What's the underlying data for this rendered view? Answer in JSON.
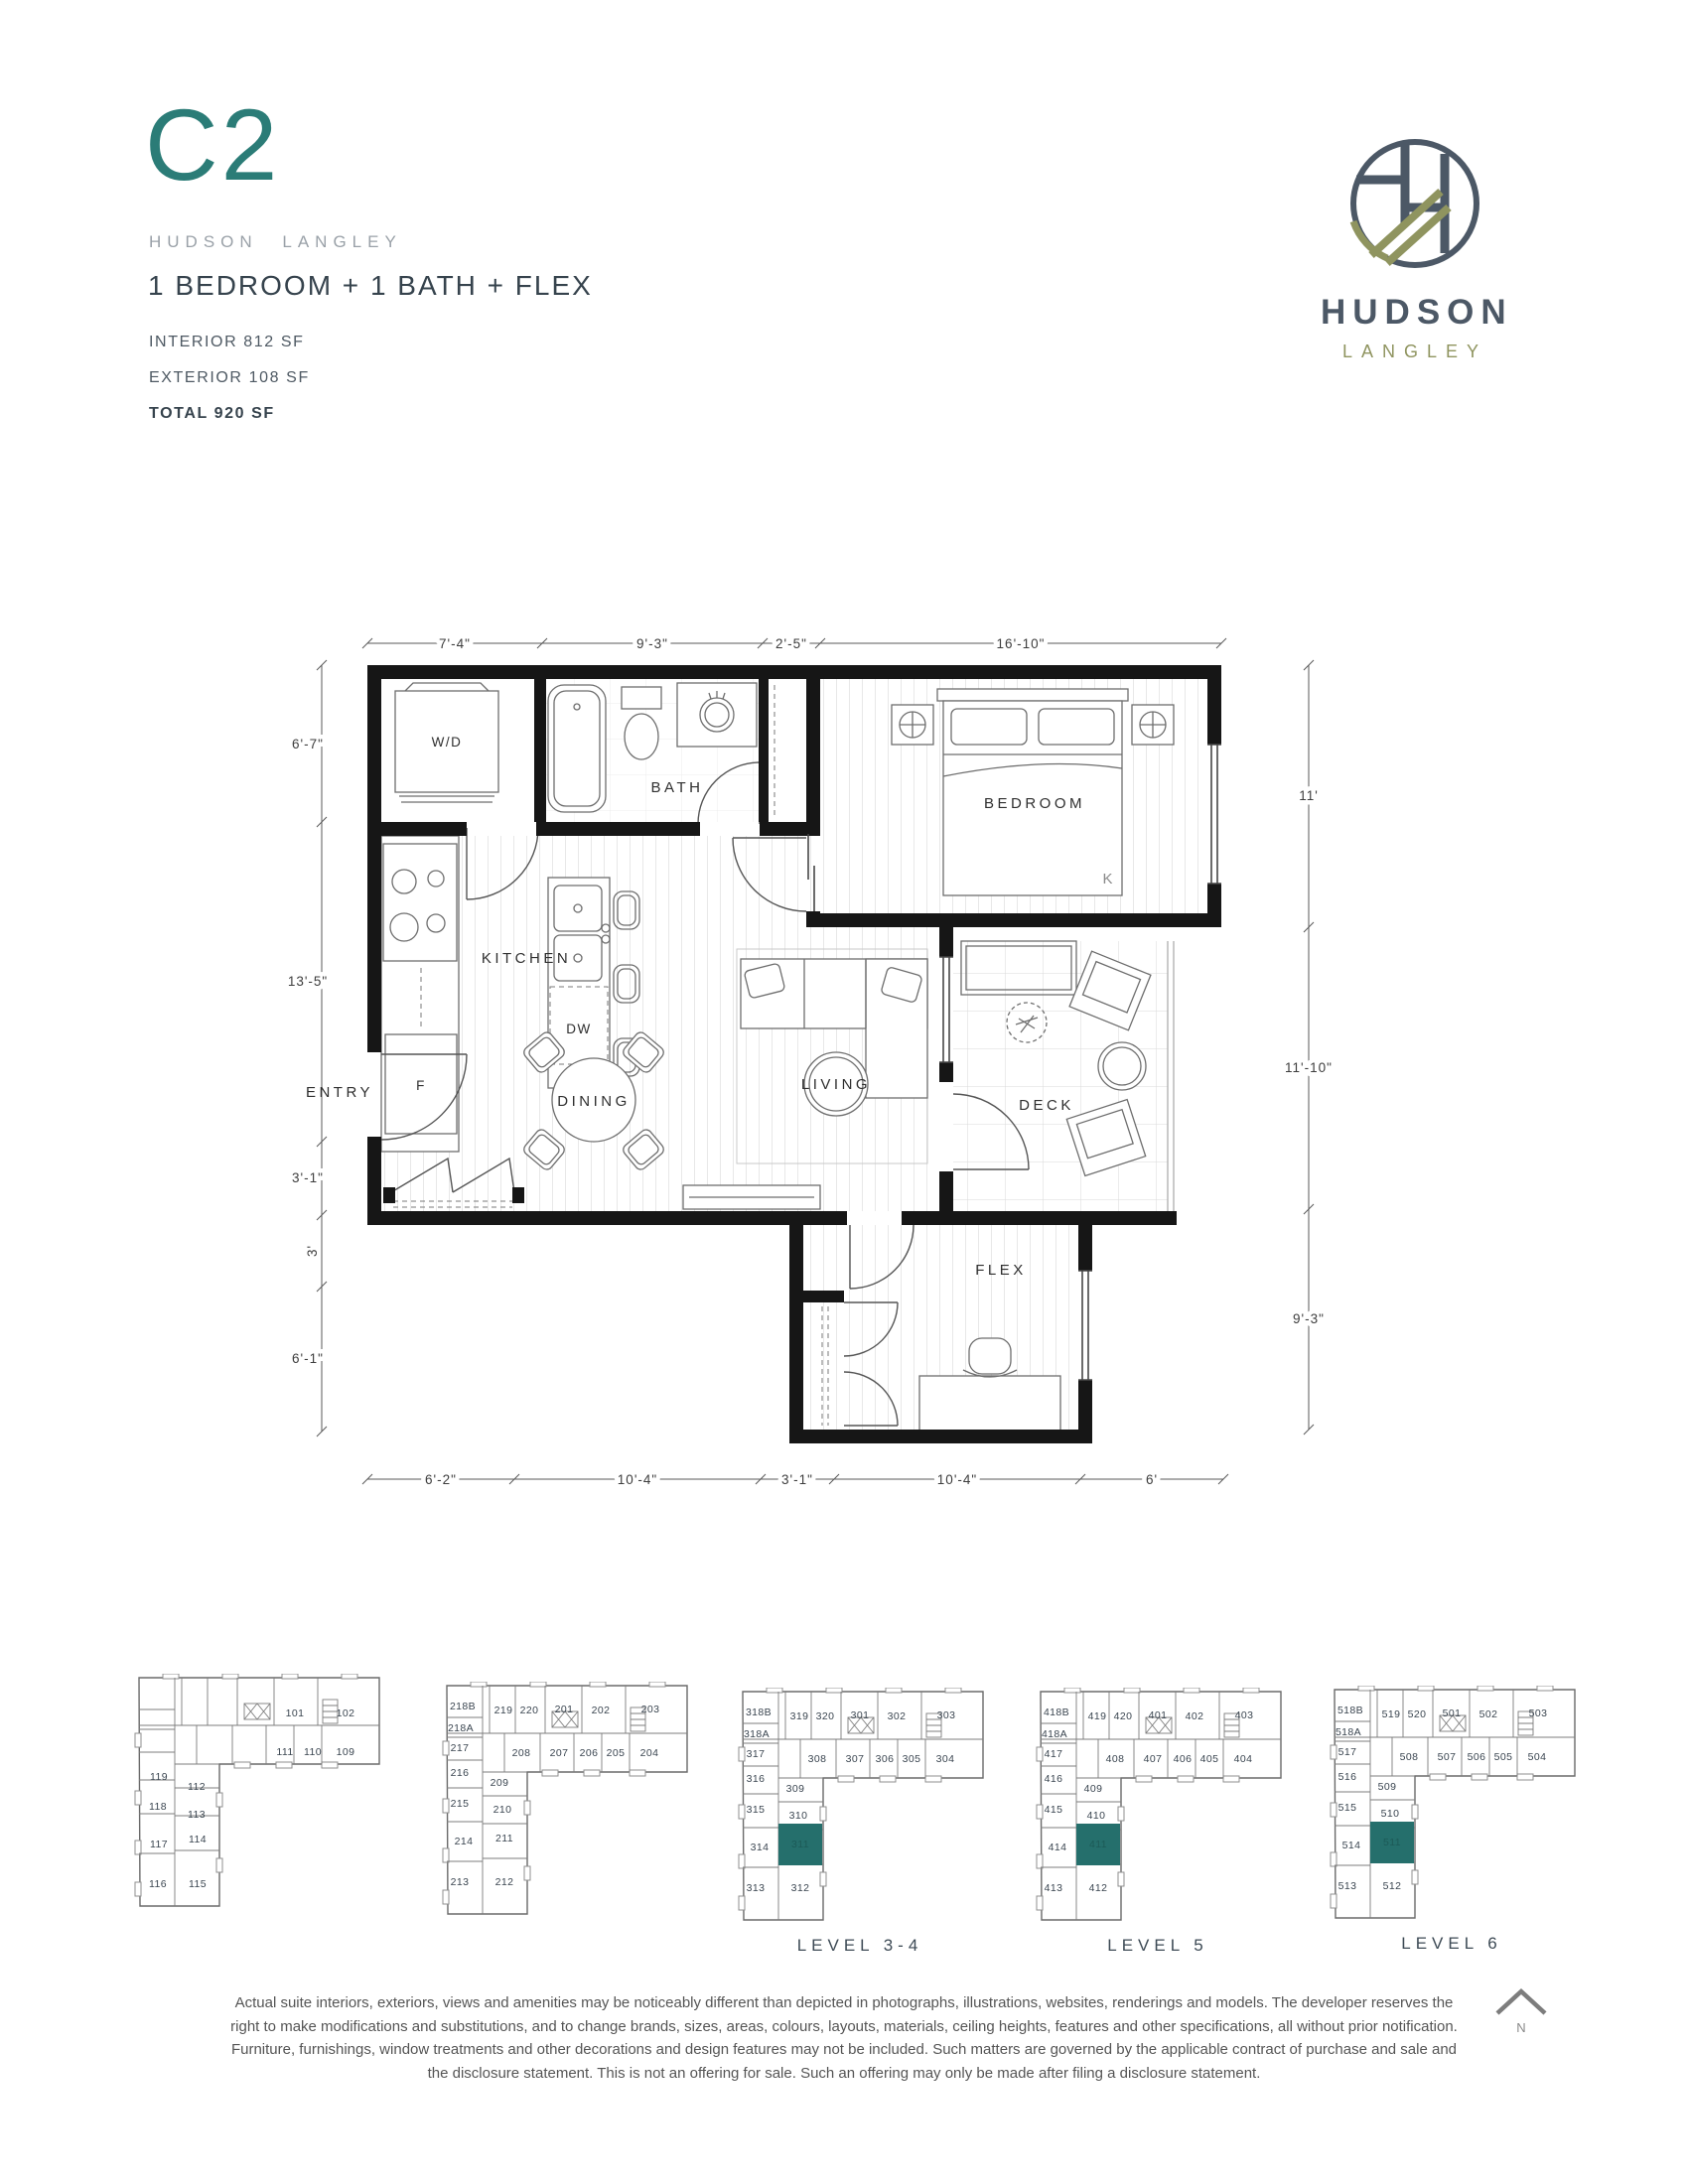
{
  "header": {
    "plan_code": "C2",
    "project_name": "HUDSON LANGLEY",
    "suite_type": "1 BEDROOM + 1 BATH + FLEX",
    "interior_label": "INTERIOR 812 SF",
    "exterior_label": "EXTERIOR 108 SF",
    "total_label": "TOTAL 920 SF"
  },
  "logo": {
    "wordmark": "HUDSON",
    "wordmark_sub": "LANGLEY"
  },
  "colors": {
    "accent_teal": "#2b7c77",
    "unit_highlight": "#256f6c",
    "slate": "#4c5866",
    "olive": "#8f945f"
  },
  "floor_plan": {
    "room_labels": {
      "wd": "W/D",
      "bath": "BATH",
      "bedroom": "BEDROOM",
      "bed_king": "K",
      "kitchen": "KITCHEN",
      "dishwasher": "DW",
      "fridge": "F",
      "entry": "ENTRY",
      "dining": "DINING",
      "living": "LIVING",
      "deck": "DECK",
      "flex": "FLEX"
    },
    "dimensions": {
      "top": [
        "7'-4\"",
        "9'-3\"",
        "2'-5\"",
        "16'-10\""
      ],
      "left": [
        "6'-7\"",
        "13'-5\"",
        "3'-1\"",
        "3'",
        "6'-1\""
      ],
      "right": [
        "11'",
        "11'-10\"",
        "9'-3\""
      ],
      "bottom": [
        "6'-2\"",
        "10'-4\"",
        "3'-1\"",
        "10'-4\"",
        "6'"
      ]
    }
  },
  "key_plans": [
    {
      "level_label": "",
      "units": [
        {
          "no": "101",
          "cls": "unit",
          "pos": "left:169px;top:40px"
        },
        {
          "no": "102",
          "cls": "unit",
          "pos": "left:220px;top:40px"
        },
        {
          "no": "111",
          "cls": "unit",
          "pos": "left:159px;top:79px"
        },
        {
          "no": "110",
          "cls": "unit",
          "pos": "left:187px;top:79px"
        },
        {
          "no": "109",
          "cls": "unit",
          "pos": "left:220px;top:79px"
        },
        {
          "no": "119",
          "cls": "unit",
          "pos": "left:32px;top:104px"
        },
        {
          "no": "112",
          "cls": "unit",
          "pos": "left:70px;top:114px"
        },
        {
          "no": "118",
          "cls": "unit",
          "pos": "left:31px;top:134px"
        },
        {
          "no": "113",
          "cls": "unit",
          "pos": "left:70px;top:142px"
        },
        {
          "no": "117",
          "cls": "unit",
          "pos": "left:32px;top:172px"
        },
        {
          "no": "114",
          "cls": "unit",
          "pos": "left:71px;top:167px"
        },
        {
          "no": "116",
          "cls": "unit",
          "pos": "left:31px;top:212px"
        },
        {
          "no": "115",
          "cls": "unit",
          "pos": "left:71px;top:212px"
        }
      ]
    },
    {
      "level_label": "",
      "units": [
        {
          "no": "218B",
          "cls": "unit",
          "pos": "left:28px;top:25px"
        },
        {
          "no": "219",
          "cls": "unit",
          "pos": "left:69px;top:29px"
        },
        {
          "no": "220",
          "cls": "unit",
          "pos": "left:95px;top:29px"
        },
        {
          "no": "201",
          "cls": "unit",
          "pos": "left:130px;top:28px"
        },
        {
          "no": "202",
          "cls": "unit",
          "pos": "left:167px;top:29px"
        },
        {
          "no": "203",
          "cls": "unit",
          "pos": "left:217px;top:28px"
        },
        {
          "no": "218A",
          "cls": "unit",
          "pos": "left:26px;top:47px"
        },
        {
          "no": "217",
          "cls": "unit",
          "pos": "left:25px;top:67px"
        },
        {
          "no": "208",
          "cls": "unit",
          "pos": "left:87px;top:72px"
        },
        {
          "no": "207",
          "cls": "unit",
          "pos": "left:125px;top:72px"
        },
        {
          "no": "206",
          "cls": "unit",
          "pos": "left:155px;top:72px"
        },
        {
          "no": "205",
          "cls": "unit",
          "pos": "left:182px;top:72px"
        },
        {
          "no": "204",
          "cls": "unit",
          "pos": "left:216px;top:72px"
        },
        {
          "no": "216",
          "cls": "unit",
          "pos": "left:25px;top:92px"
        },
        {
          "no": "209",
          "cls": "unit",
          "pos": "left:65px;top:102px"
        },
        {
          "no": "215",
          "cls": "unit",
          "pos": "left:25px;top:123px"
        },
        {
          "no": "210",
          "cls": "unit",
          "pos": "left:68px;top:129px"
        },
        {
          "no": "214",
          "cls": "unit",
          "pos": "left:29px;top:161px"
        },
        {
          "no": "211",
          "cls": "unit",
          "pos": "left:70px;top:158px"
        },
        {
          "no": "213",
          "cls": "unit",
          "pos": "left:25px;top:202px"
        },
        {
          "no": "212",
          "cls": "unit",
          "pos": "left:70px;top:202px"
        }
      ]
    },
    {
      "level_label": "LEVEL 3-4",
      "units": [
        {
          "no": "318B",
          "cls": "unit",
          "pos": "left:28px;top:25px"
        },
        {
          "no": "319",
          "cls": "unit",
          "pos": "left:69px;top:29px"
        },
        {
          "no": "320",
          "cls": "unit",
          "pos": "left:95px;top:29px"
        },
        {
          "no": "301",
          "cls": "unit",
          "pos": "left:130px;top:28px"
        },
        {
          "no": "302",
          "cls": "unit",
          "pos": "left:167px;top:29px"
        },
        {
          "no": "303",
          "cls": "unit",
          "pos": "left:217px;top:28px"
        },
        {
          "no": "318A",
          "cls": "unit",
          "pos": "left:26px;top:47px"
        },
        {
          "no": "317",
          "cls": "unit",
          "pos": "left:25px;top:67px"
        },
        {
          "no": "308",
          "cls": "unit",
          "pos": "left:87px;top:72px"
        },
        {
          "no": "307",
          "cls": "unit",
          "pos": "left:125px;top:72px"
        },
        {
          "no": "306",
          "cls": "unit",
          "pos": "left:155px;top:72px"
        },
        {
          "no": "305",
          "cls": "unit",
          "pos": "left:182px;top:72px"
        },
        {
          "no": "304",
          "cls": "unit",
          "pos": "left:216px;top:72px"
        },
        {
          "no": "316",
          "cls": "unit",
          "pos": "left:25px;top:92px"
        },
        {
          "no": "309",
          "cls": "unit",
          "pos": "left:65px;top:102px"
        },
        {
          "no": "315",
          "cls": "unit",
          "pos": "left:25px;top:123px"
        },
        {
          "no": "310",
          "cls": "unit",
          "pos": "left:68px;top:129px"
        },
        {
          "no": "314",
          "cls": "unit",
          "pos": "left:29px;top:161px"
        },
        {
          "no": "311",
          "cls": "unit hl",
          "pos": "left:70px;top:158px"
        },
        {
          "no": "313",
          "cls": "unit",
          "pos": "left:25px;top:202px"
        },
        {
          "no": "312",
          "cls": "unit",
          "pos": "left:70px;top:202px"
        }
      ]
    },
    {
      "level_label": "LEVEL 5",
      "units": [
        {
          "no": "418B",
          "cls": "unit",
          "pos": "left:28px;top:25px"
        },
        {
          "no": "419",
          "cls": "unit",
          "pos": "left:69px;top:29px"
        },
        {
          "no": "420",
          "cls": "unit",
          "pos": "left:95px;top:29px"
        },
        {
          "no": "401",
          "cls": "unit",
          "pos": "left:130px;top:28px"
        },
        {
          "no": "402",
          "cls": "unit",
          "pos": "left:167px;top:29px"
        },
        {
          "no": "403",
          "cls": "unit",
          "pos": "left:217px;top:28px"
        },
        {
          "no": "418A",
          "cls": "unit",
          "pos": "left:26px;top:47px"
        },
        {
          "no": "417",
          "cls": "unit",
          "pos": "left:25px;top:67px"
        },
        {
          "no": "408",
          "cls": "unit",
          "pos": "left:87px;top:72px"
        },
        {
          "no": "407",
          "cls": "unit",
          "pos": "left:125px;top:72px"
        },
        {
          "no": "406",
          "cls": "unit",
          "pos": "left:155px;top:72px"
        },
        {
          "no": "405",
          "cls": "unit",
          "pos": "left:182px;top:72px"
        },
        {
          "no": "404",
          "cls": "unit",
          "pos": "left:216px;top:72px"
        },
        {
          "no": "416",
          "cls": "unit",
          "pos": "left:25px;top:92px"
        },
        {
          "no": "409",
          "cls": "unit",
          "pos": "left:65px;top:102px"
        },
        {
          "no": "415",
          "cls": "unit",
          "pos": "left:25px;top:123px"
        },
        {
          "no": "410",
          "cls": "unit",
          "pos": "left:68px;top:129px"
        },
        {
          "no": "414",
          "cls": "unit",
          "pos": "left:29px;top:161px"
        },
        {
          "no": "411",
          "cls": "unit hl",
          "pos": "left:70px;top:158px"
        },
        {
          "no": "413",
          "cls": "unit",
          "pos": "left:25px;top:202px"
        },
        {
          "no": "412",
          "cls": "unit",
          "pos": "left:70px;top:202px"
        }
      ]
    },
    {
      "level_label": "LEVEL 6",
      "units": [
        {
          "no": "518B",
          "cls": "unit",
          "pos": "left:28px;top:25px"
        },
        {
          "no": "519",
          "cls": "unit",
          "pos": "left:69px;top:29px"
        },
        {
          "no": "520",
          "cls": "unit",
          "pos": "left:95px;top:29px"
        },
        {
          "no": "501",
          "cls": "unit",
          "pos": "left:130px;top:28px"
        },
        {
          "no": "502",
          "cls": "unit",
          "pos": "left:167px;top:29px"
        },
        {
          "no": "503",
          "cls": "unit",
          "pos": "left:217px;top:28px"
        },
        {
          "no": "518A",
          "cls": "unit",
          "pos": "left:26px;top:47px"
        },
        {
          "no": "517",
          "cls": "unit",
          "pos": "left:25px;top:67px"
        },
        {
          "no": "516",
          "cls": "unit",
          "pos": "left:25px;top:92px"
        },
        {
          "no": "508",
          "cls": "unit",
          "pos": "left:87px;top:72px"
        },
        {
          "no": "507",
          "cls": "unit",
          "pos": "left:125px;top:72px"
        },
        {
          "no": "506",
          "cls": "unit",
          "pos": "left:155px;top:72px"
        },
        {
          "no": "505",
          "cls": "unit",
          "pos": "left:182px;top:72px"
        },
        {
          "no": "504",
          "cls": "unit",
          "pos": "left:216px;top:72px"
        },
        {
          "no": "515",
          "cls": "unit",
          "pos": "left:25px;top:123px"
        },
        {
          "no": "509",
          "cls": "unit",
          "pos": "left:65px;top:102px"
        },
        {
          "no": "510",
          "cls": "unit",
          "pos": "left:68px;top:129px"
        },
        {
          "no": "514",
          "cls": "unit",
          "pos": "left:29px;top:161px"
        },
        {
          "no": "511",
          "cls": "unit hl",
          "pos": "left:70px;top:158px"
        },
        {
          "no": "513",
          "cls": "unit",
          "pos": "left:25px;top:202px"
        },
        {
          "no": "512",
          "cls": "unit",
          "pos": "left:70px;top:202px"
        }
      ]
    }
  ],
  "north_label": "N",
  "disclaimer": {
    "line1": "Actual suite interiors, exteriors, views and amenities may be noticeably different than depicted in photographs, illustrations, websites, renderings and models. The developer reserves the",
    "line2": "right to make modifications and substitutions, and to change brands, sizes, areas, colours, layouts, materials, ceiling heights, features and other specifications, all without prior notification.",
    "line3": "Furniture, furnishings, window treatments and other decorations and design features may not be included. Such matters are governed by the applicable contract of purchase and sale and",
    "line4": "the disclosure statement. This is not an offering for sale. Such an offering may only be made after filing a disclosure statement."
  }
}
